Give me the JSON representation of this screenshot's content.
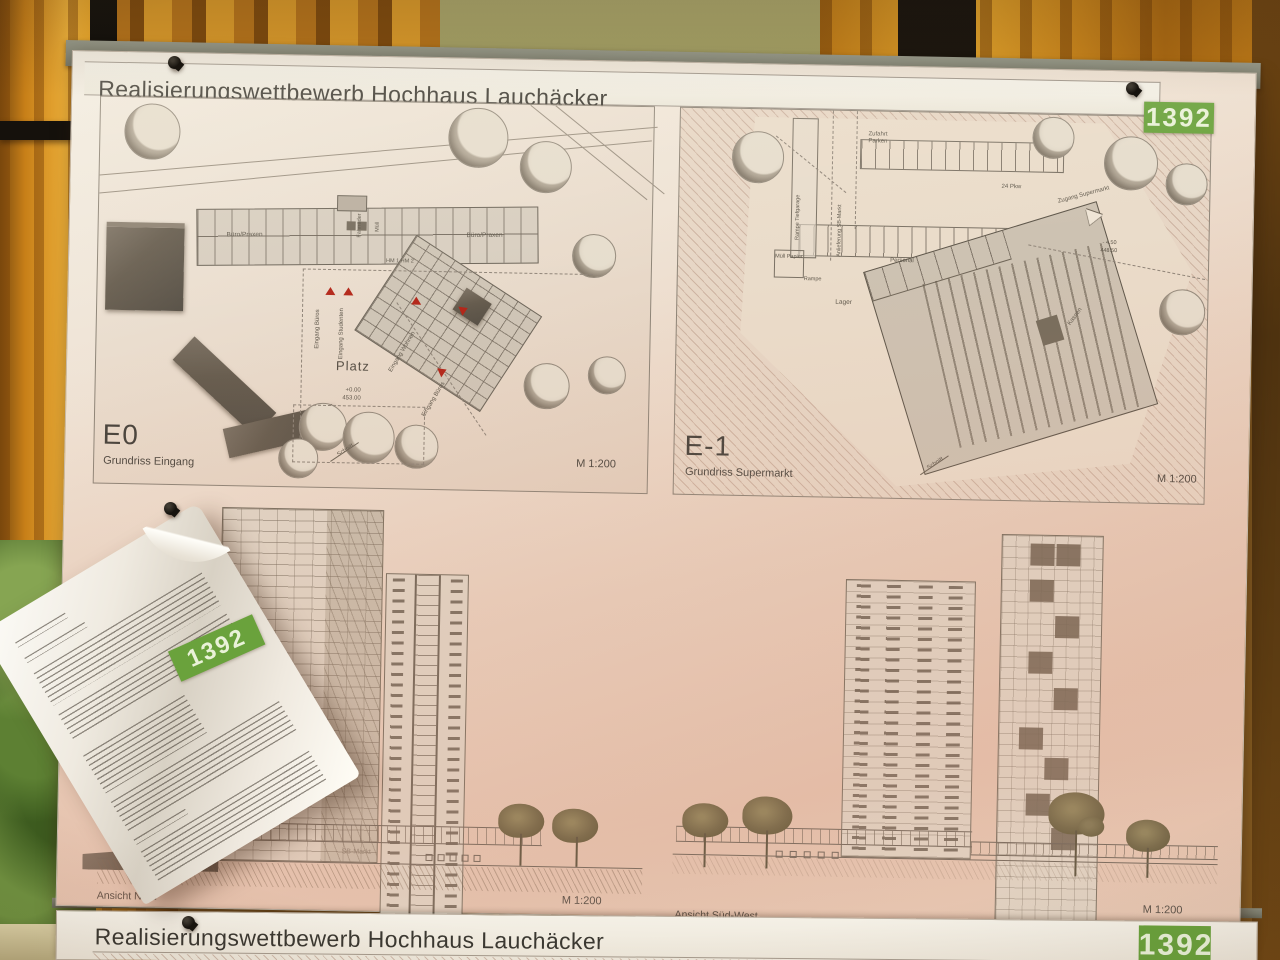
{
  "badge": {
    "number": "1392",
    "color": "#6aa23c"
  },
  "poster_top": {
    "title": "Realisierungswettbewerb Hochhaus Lauchäcker",
    "panel_e0": {
      "code": "E0",
      "caption": "Grundriss Eingang",
      "scale": "M 1:200",
      "labels": {
        "buero_praxen_a": "Büro/Praxen",
        "buero_praxen_b": "Büro/Praxen",
        "fahrraeder": "Fahrräder",
        "muell": "Müll",
        "hm": "HM 1  HM 2",
        "eingang_bueros_a": "Eingang Büros",
        "eingang_studenten": "Eingang Studenten",
        "eingang_wohnen": "Eingang Wohnen",
        "eingang_bueros_b": "Eingang Büros",
        "platz": "Platz",
        "level_rel": "+0.00",
        "level_abs": "453.00",
        "schnitt": "Schnitt"
      }
    },
    "panel_e1": {
      "code": "E-1",
      "caption": "Grundriss Supermarkt",
      "scale": "M 1:200",
      "labels": {
        "rampe_tiefgarage": "Rampe Tiefgarage",
        "anlieferung": "Anlieferung SB-Markt",
        "zufahrt_parken": "Zufahrt Parken",
        "pkw": "24 Pkw",
        "zugang_supermarkt": "Zugang Supermarkt",
        "level_rel": "- 4.50",
        "level_abs": "448.50",
        "muell_papier": "Müll Papier",
        "rampe": "Rampe",
        "personal": "Personal",
        "lager": "Lager",
        "kassen": "Kassen",
        "schnitt": "Schnitt"
      }
    },
    "ansicht_nord": {
      "caption": "Ansicht Nord",
      "scale": "M 1:200",
      "sb_markt": "SB-Markt"
    },
    "ansicht_suedwest": {
      "caption": "Ansicht Süd-West",
      "scale": "M 1:200"
    }
  },
  "note": {
    "badge": "1392"
  },
  "poster_bottom": {
    "title": "Realisierungswettbewerb Hochhaus Lauchäcker",
    "badge": "1392"
  }
}
